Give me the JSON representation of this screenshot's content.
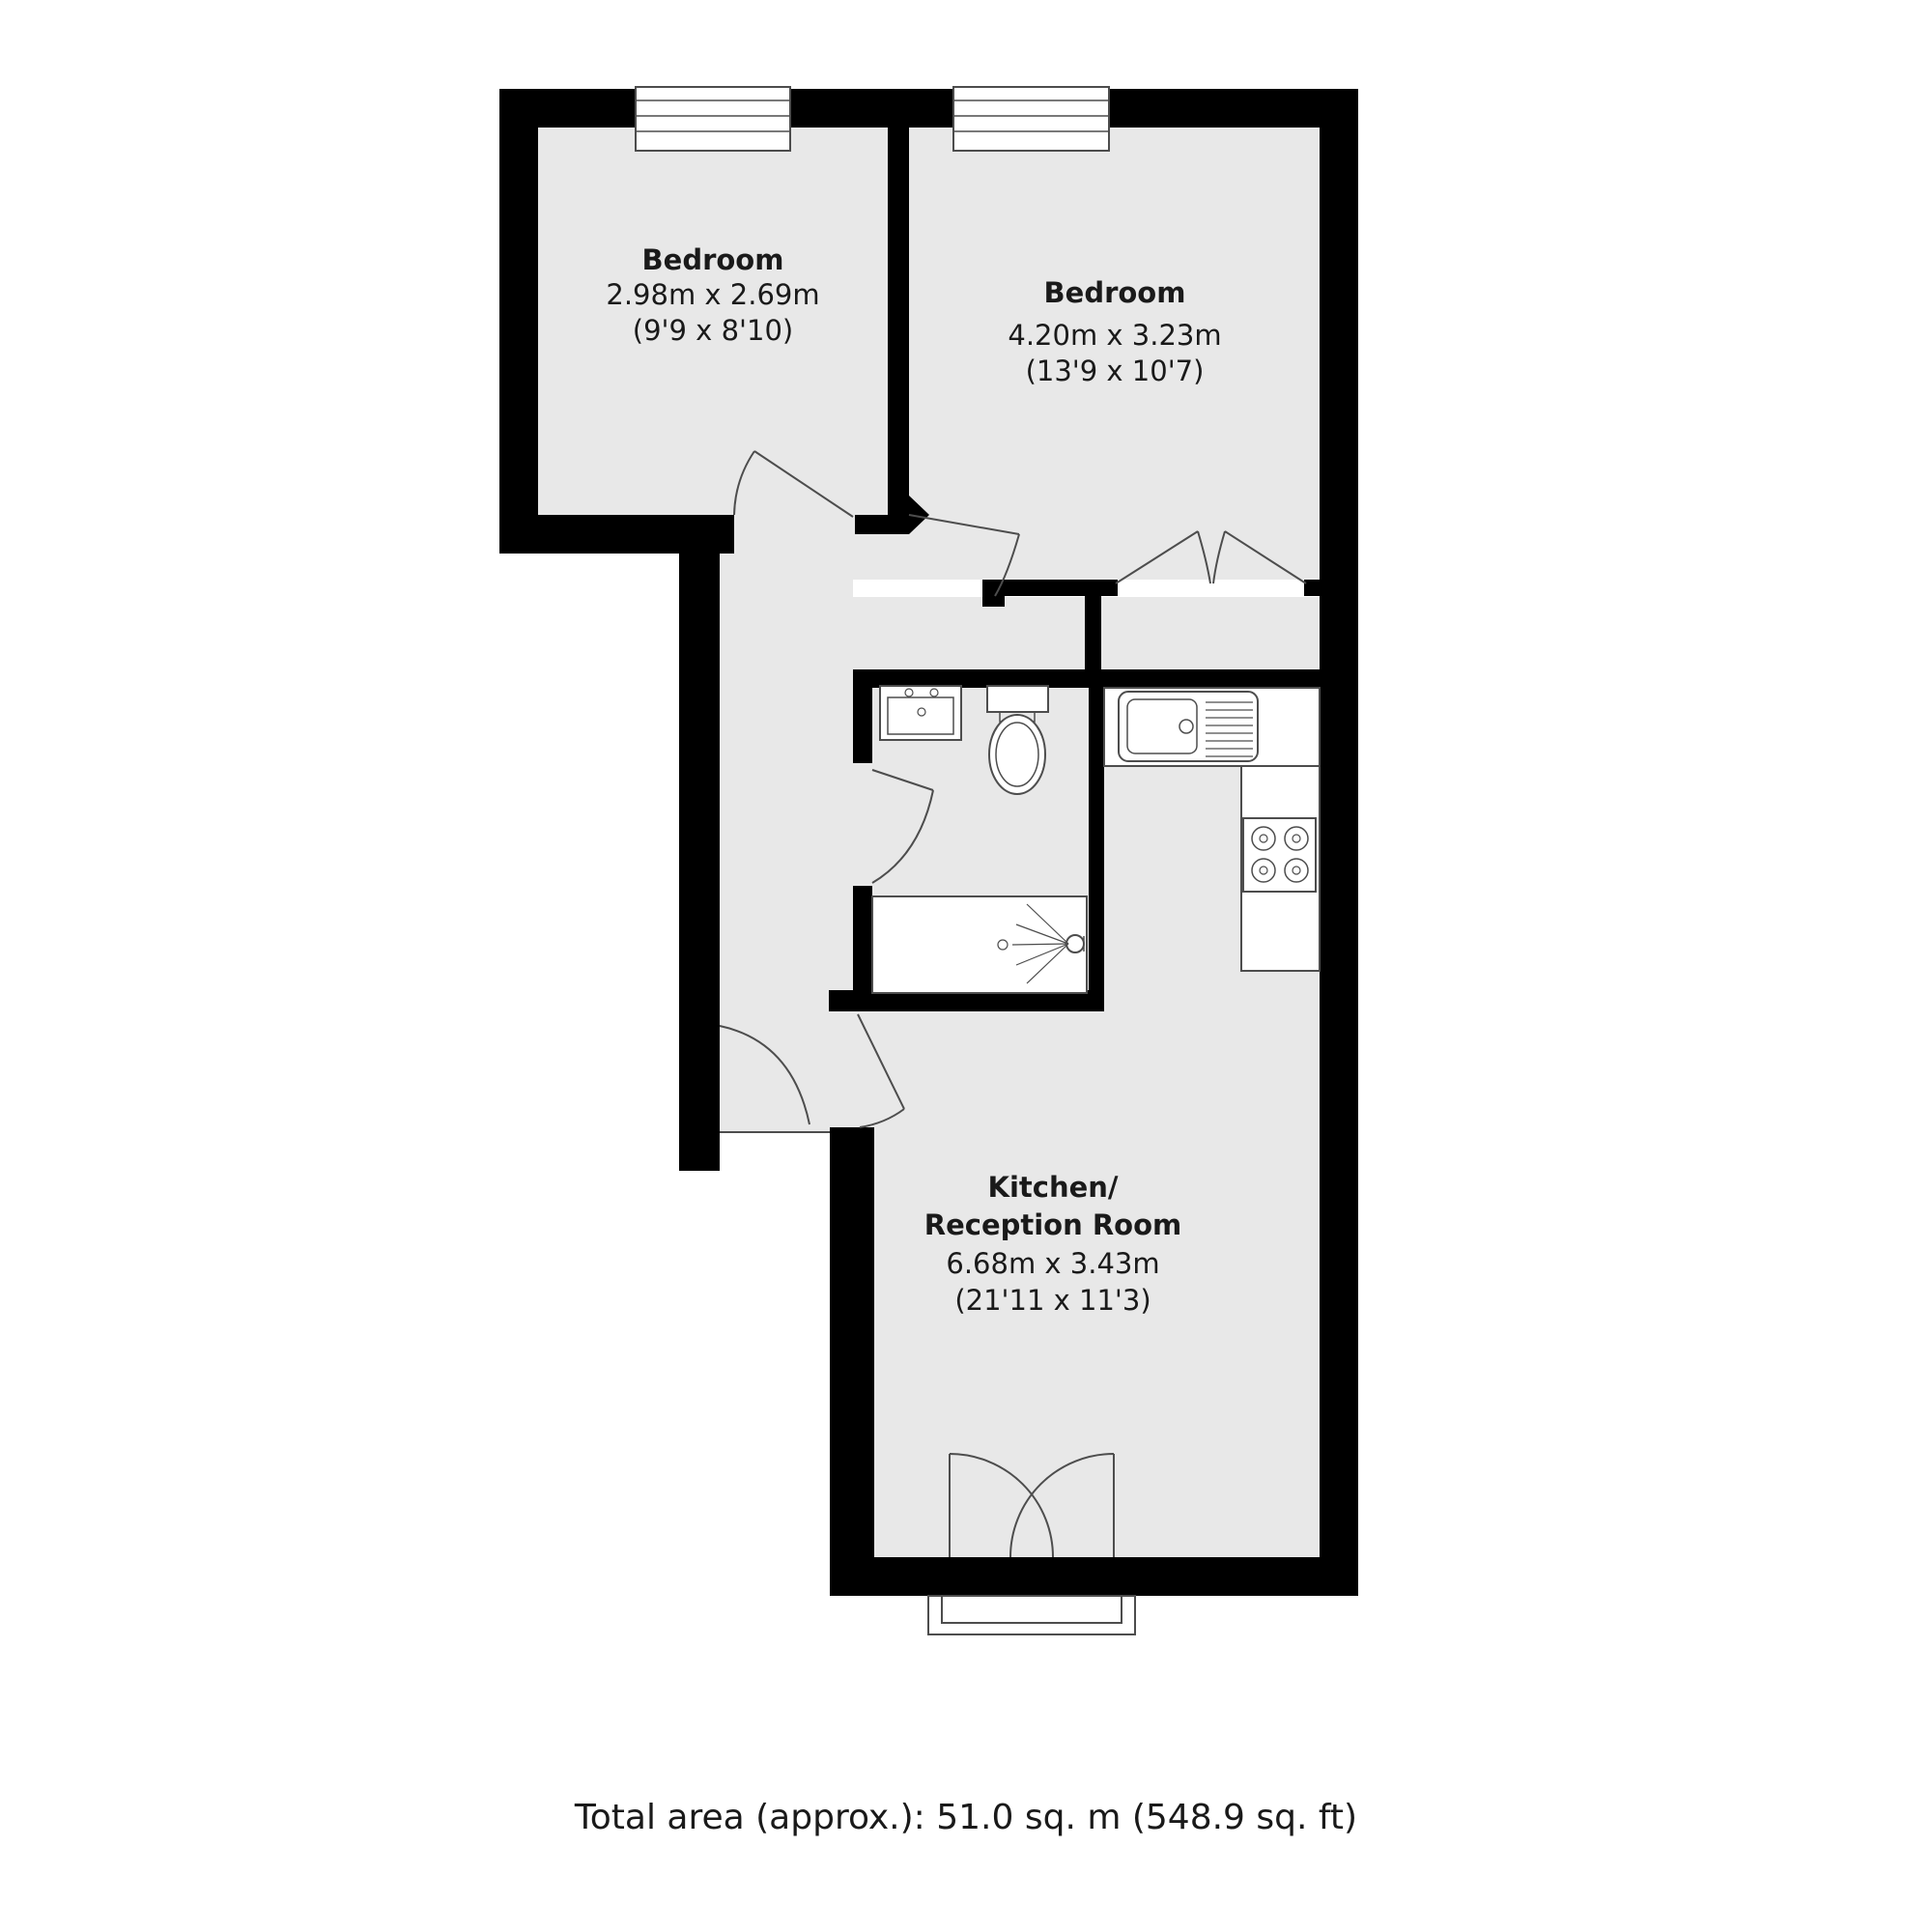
{
  "floorplan": {
    "rooms": {
      "bedroom1": {
        "name": "Bedroom",
        "size_metric": "2.98m x 2.69m",
        "size_imperial": "(9'9 x 8'10)"
      },
      "bedroom2": {
        "name": "Bedroom",
        "size_metric": "4.20m x 3.23m",
        "size_imperial": "(13'9 x 10'7)"
      },
      "kitchen_reception": {
        "name_line1": "Kitchen/",
        "name_line2": "Reception Room",
        "size_metric": "6.68m x 3.43m",
        "size_imperial": "(21'11 x 11'3)"
      }
    },
    "footer": {
      "total_area": "Total area (approx.): 51.0 sq. m (548.9 sq. ft)"
    },
    "colors": {
      "wall": "#000000",
      "floor": "#e8e8e8",
      "outline": "#4d4d4d",
      "text": "#1a1a1a",
      "page_bg": "#ffffff"
    }
  }
}
